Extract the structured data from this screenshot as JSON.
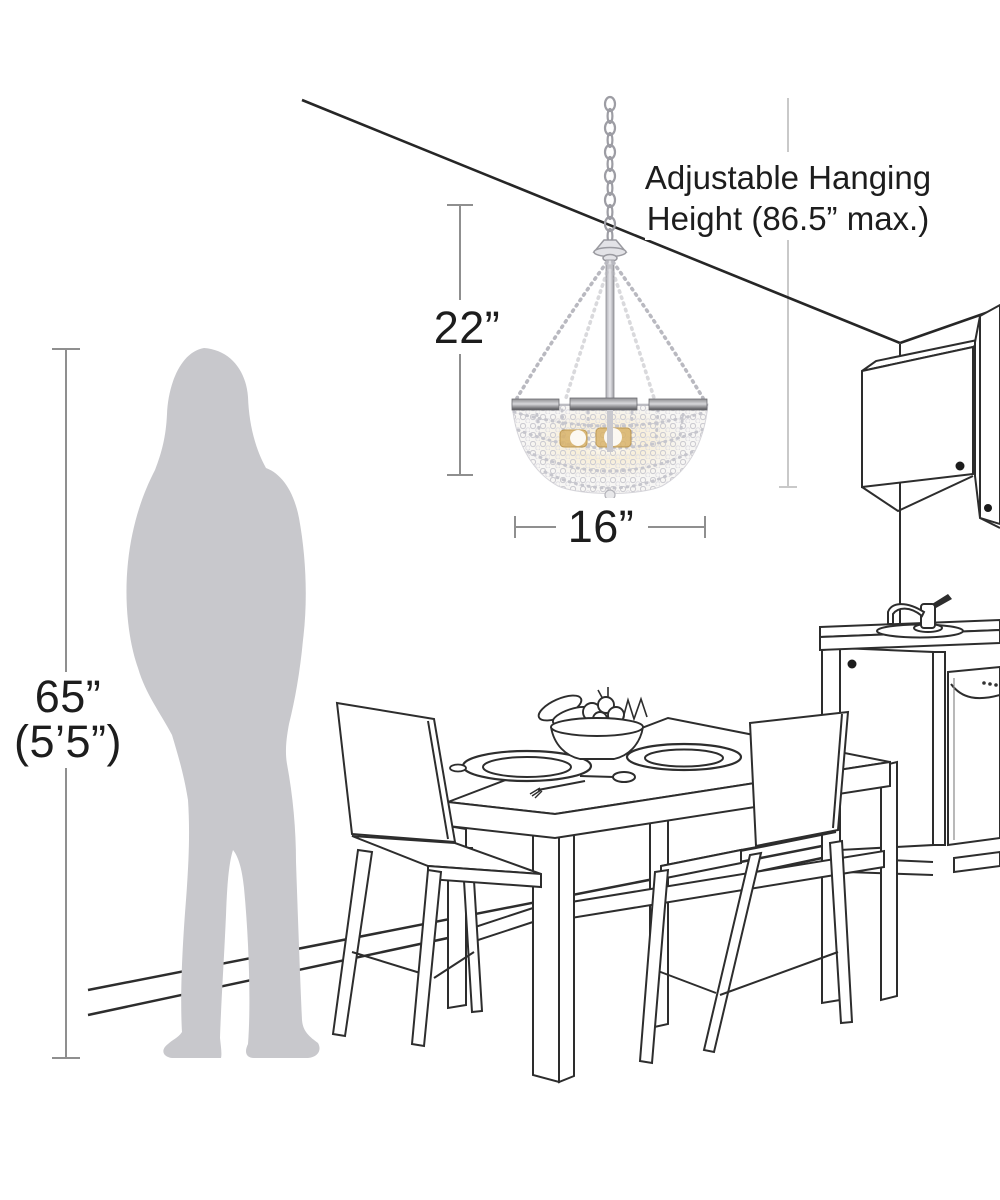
{
  "diagram": {
    "type": "product-dimension-diagram",
    "subject": "crystal beaded chandelier shown to scale in a dining room with kitchen",
    "labels": {
      "hanging_height_line1": "Adjustable Hanging",
      "hanging_height_line2": "Height (86.5” max.)",
      "fixture_height": "22”",
      "fixture_width": "16”",
      "person_height_line1": "65”",
      "person_height_line2": "(5’5”)"
    },
    "dimension_values": {
      "adjustable_hanging_height_max_in": 86.5,
      "fixture_height_in": 22,
      "fixture_width_in": 16,
      "person_height_in": 65,
      "person_height_ft_in": "5'5\""
    },
    "colors": {
      "background": "#ffffff",
      "line_art": "#2d2d2d",
      "dimension_line": "#8f8f8f",
      "dimension_line_light": "#c9c9c9",
      "text": "#1d1d1d",
      "person_silhouette": "#c8c8cc",
      "chrome_band_dark": "#55555a",
      "chrome_band_light": "#d7d7da",
      "crystal_bead": "#cdccd2",
      "bulb_glow": "#f8edd2",
      "bulb_amber": "#d9b36a"
    },
    "scene_elements": [
      "ceiling corner line",
      "right wall corner",
      "baseboard",
      "person silhouette (65 in tall)",
      "crystal chandelier with chain",
      "dining table with two plates, fork, spoon and fruit bowl",
      "two dining chairs",
      "upper kitchen cabinets with knobs",
      "kitchen counter with sink and faucet",
      "dishwasher"
    ]
  }
}
